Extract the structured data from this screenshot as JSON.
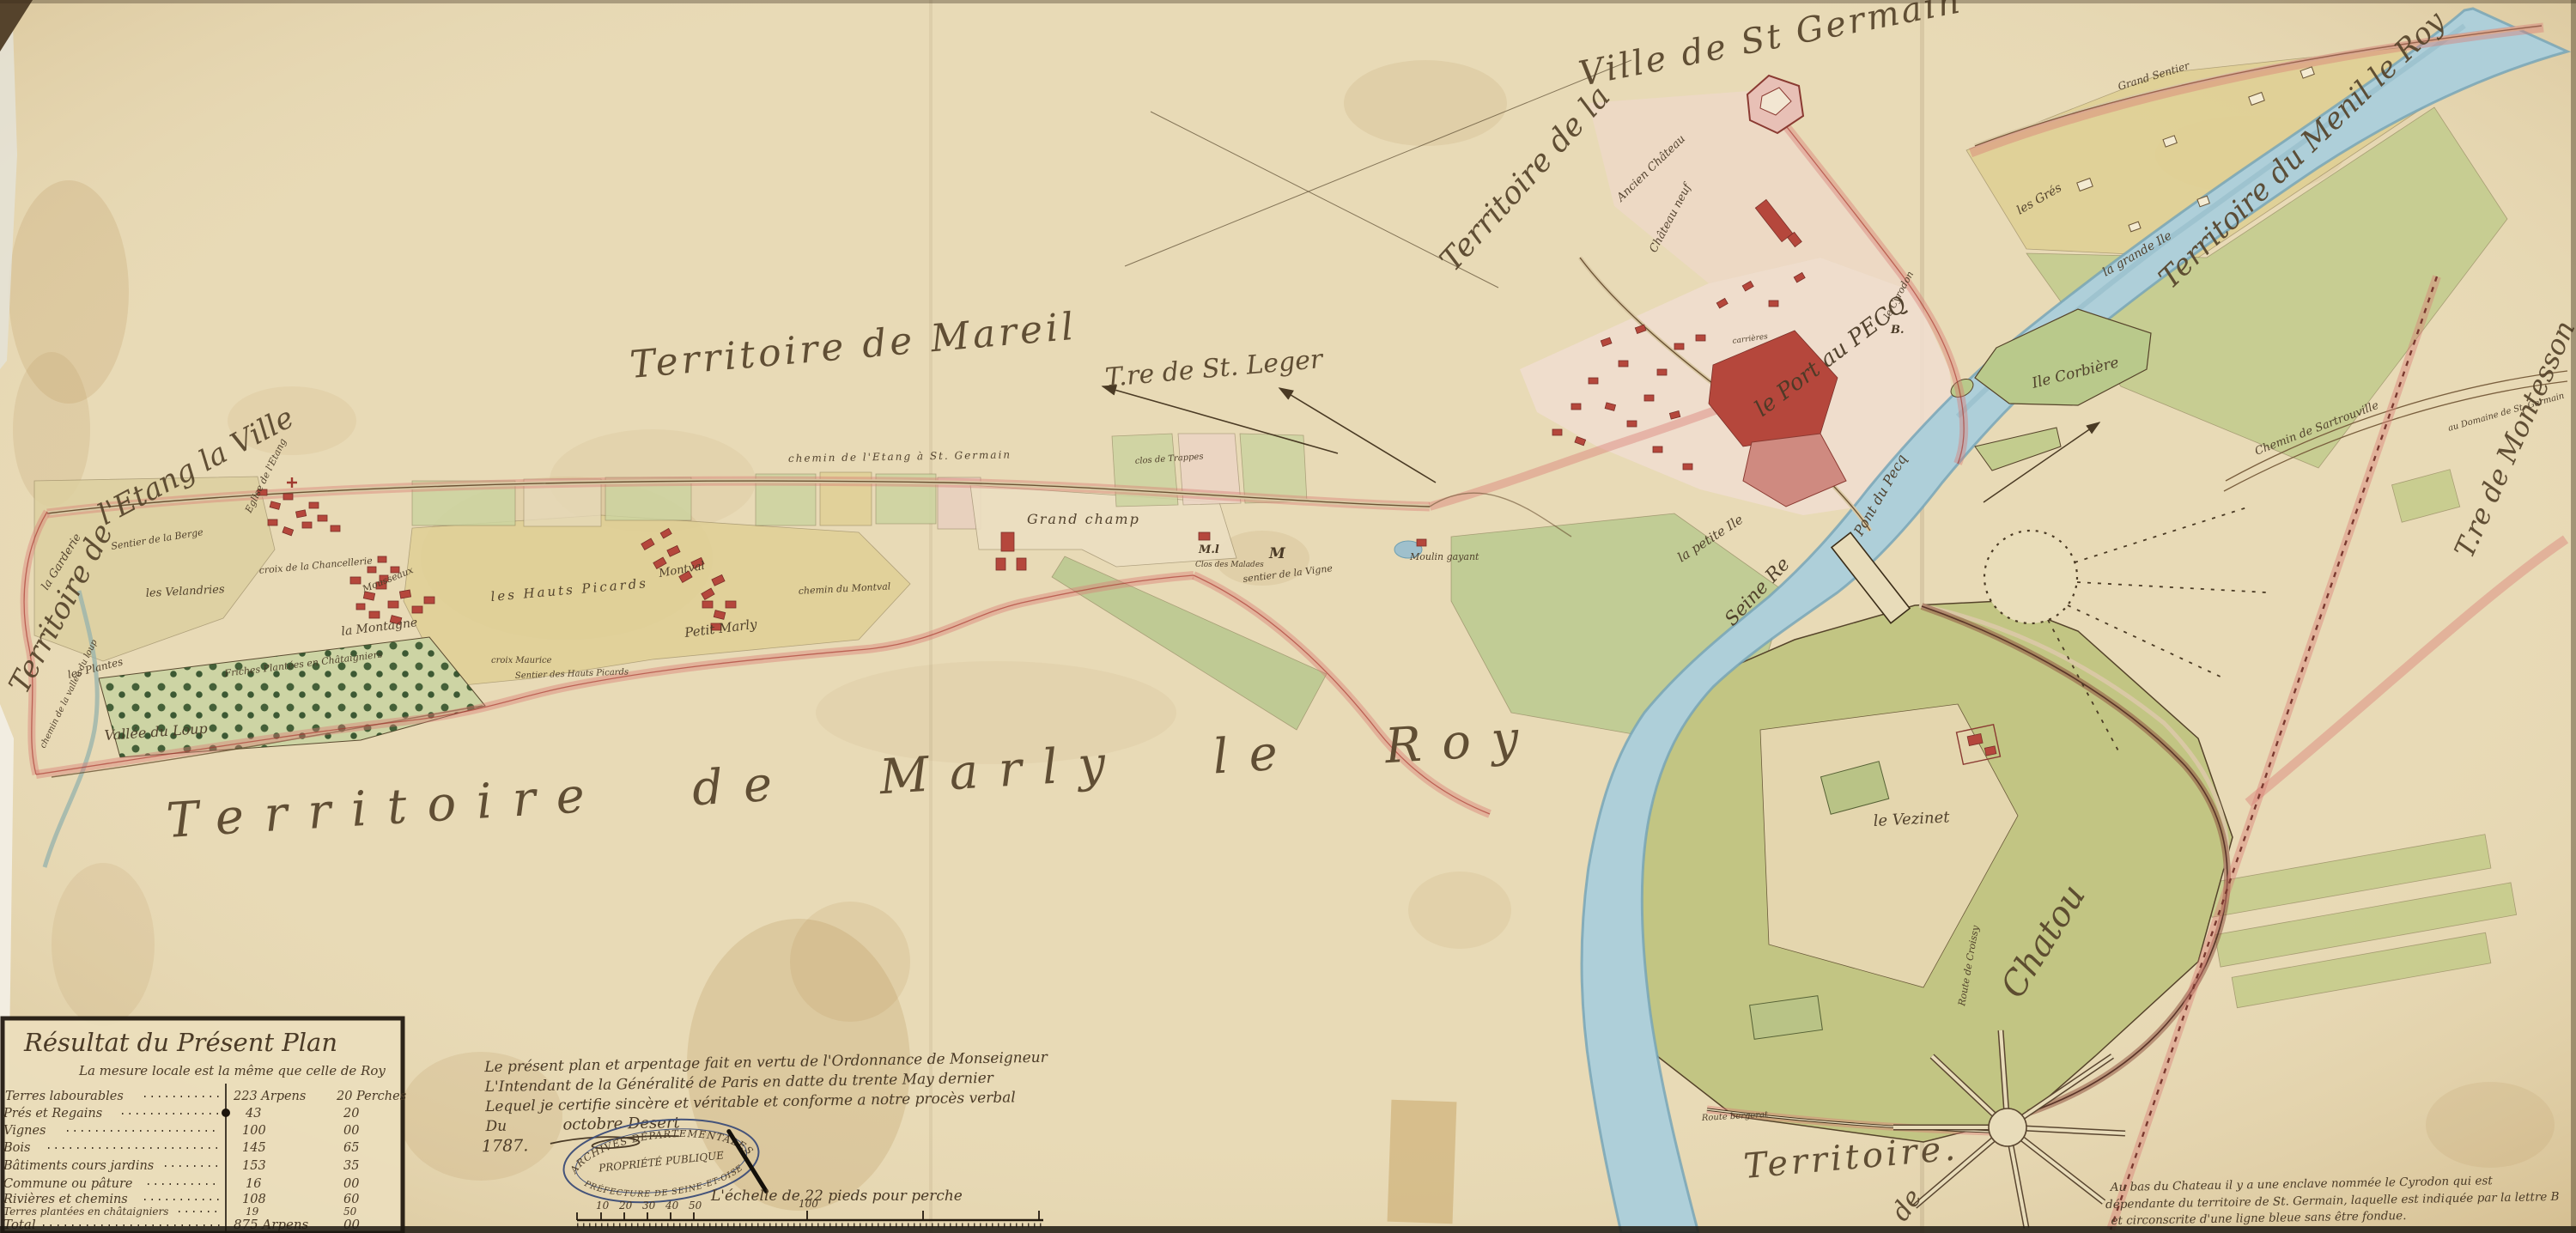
{
  "palette": {
    "parchment": "#e8dab6",
    "river": "#aecfd9",
    "river_edge": "#74a3b5",
    "park_green": "#c2c583",
    "field_green": "#c8d09c",
    "field_yellow": "#e0d096",
    "town_pink": "#f0ddce",
    "building_red": "#b5473c",
    "boundary_pink": "#d97b74",
    "ink": "#4a3a26",
    "stamp_blue": "#44537a"
  },
  "territories": {
    "etang_1": "Territoire de",
    "etang_2": "l'Etang la Ville",
    "mareil": "Territoire de Mareil",
    "st_germain_1": "Territoire de la",
    "st_germain_2": "Ville de St Germain",
    "mesnil": "Territoire du Menil le Roy",
    "marly": "Territoire de Marly le Roy",
    "st_leger": "T.re de St. Leger",
    "montesson": "T.re de Montesson",
    "chatou_territoire": "Territoire.",
    "chatou_de": "de",
    "chatou": "Chatou"
  },
  "places": {
    "ancien_chateau": "Ancien Château",
    "chateau_neuf": "Château neuf",
    "port_au_pecq": "le Port au PECQ",
    "pont_du_pecq": "Pont du Pecq",
    "ile_corbiere": "Ile Corbière",
    "petite_ile": "la petite Ile",
    "seine": "Seine Re",
    "vezinet": "le Vezinet",
    "les_gres": "les Grés",
    "grande_ile": "la grande Ile",
    "grand_sentier": "Grand Sentier",
    "vallee_du_loup": "Vallée du Loup",
    "garderie": "la Garderie",
    "sentier_berge": "Sentier de la Berge",
    "velandries": "les Velandries",
    "croix_chancellerie": "croix de la Chancellerie",
    "montagne": "la Montagne",
    "hauts_picards": "les Hauts Picards",
    "croix_maurice": "croix Maurice",
    "sentier_picards": "Sentier des Hauts Picards",
    "montval": "Montval",
    "petit_marly": "Petit Marly",
    "friches": "Friches Plantées en Châtaigniers",
    "les_plantes": "les Plantes",
    "chemin_vallee": "chemin de la vallée du loup",
    "eglise_etang": "Eglise de l'Etang",
    "moulin_gayant": "Moulin gayant",
    "grand_champ": "Grand champ",
    "chemin_montval": "chemin du Montval",
    "mousseaux": "Mousseaux",
    "clos_malades": "Clos des Malades",
    "mark_ml": "M.l",
    "mark_m": "M",
    "sentier_vigne": "sentier de la Vigne",
    "clos_trappes": "clos de Trappes",
    "chemin_etang": "chemin de l'Etang à St. Germain",
    "route_bergerat": "Route bergerat",
    "route_croissy": "Route de Croissy",
    "chemin_sartrouville": "Chemin de Sartrouville",
    "domaine_stg": "au Domaine de St. Germain",
    "cyrodon": "le Cyrodon",
    "cyrodon_b": "B.",
    "carrieres": "carrières"
  },
  "legend": {
    "title": "Résultat du Présent Plan",
    "subtitle": "La mesure locale est la même que celle de Roy",
    "rows": [
      {
        "name": "Terres labourables",
        "arpens": "223 Arpens",
        "perches": "20 Perches"
      },
      {
        "name": "Prés et Regains",
        "arpens": "43",
        "perches": "20"
      },
      {
        "name": "Vignes",
        "arpens": "100",
        "perches": "00"
      },
      {
        "name": "Bois",
        "arpens": "145",
        "perches": "65"
      },
      {
        "name": "Bâtiments cours jardins",
        "arpens": "153",
        "perches": "35"
      },
      {
        "name": "Commune ou pâture",
        "arpens": "16",
        "perches": "00"
      },
      {
        "name": "Rivières et chemins",
        "arpens": "108",
        "perches": "60"
      },
      {
        "name": "Terres plantées en châtaigniers",
        "arpens": "19",
        "perches": "50"
      },
      {
        "name": "Total",
        "arpens": "875 Arpens",
        "perches": "00"
      }
    ]
  },
  "certificate": {
    "line1": "Le présent plan et arpentage fait en vertu de l'Ordonnance de Monseigneur",
    "line2": "L'Intendant de la Généralité de Paris en datte du trente May dernier",
    "line3": "Lequel je certifie sincère et véritable et conforme a notre procès verbal",
    "line4a": "Du",
    "line4b": "octobre  Desert",
    "year": "1787."
  },
  "stamp": {
    "line1": "ARCHIVES DÉPARTEMENTALES",
    "line2": "PROPRIÉTÉ PUBLIQUE",
    "line3": "PRÉFECTURE DE SEINE-ET-OISE"
  },
  "scale": {
    "label": "L'échelle de 22 pieds pour perche",
    "ticks": [
      "10",
      "20",
      "30",
      "40",
      "50",
      "100"
    ]
  },
  "note": {
    "line1": "Au bas du Chateau il y a une enclave nommée le Cyrodon qui est",
    "line2": "dépendante du territoire de St. Germain, laquelle est indiquée par la lettre B",
    "line3": "et circonscrite d'une ligne bleue sans être fondue."
  }
}
